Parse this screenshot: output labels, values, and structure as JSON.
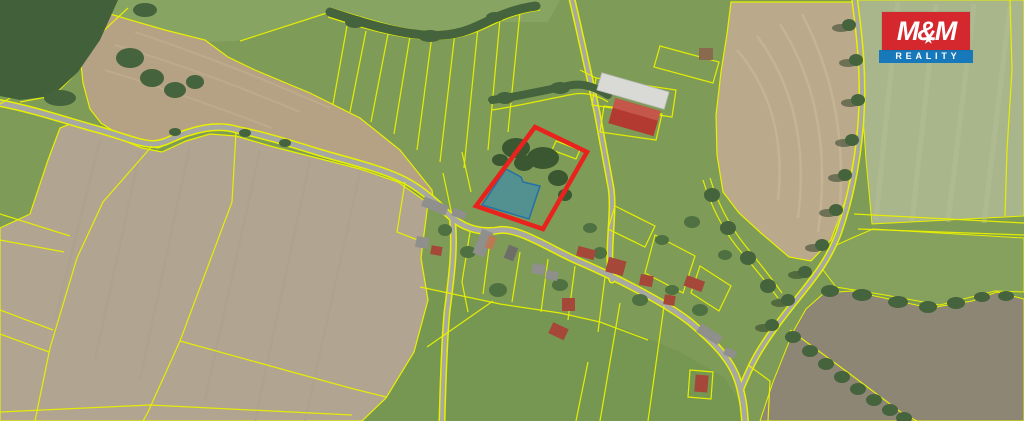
{
  "logo": {
    "brand": "M&M",
    "tagline": "REALITY",
    "star": "★"
  },
  "map": {
    "kind": "aerial-cadastral-map",
    "highlighted_parcel_outline": "#e8231e",
    "selected_area_fill": "#2f86c0",
    "cadastral_line_color": "#e8f000"
  },
  "colors": {
    "c-base": "#7e9b57",
    "c-meadow": "#769751",
    "c-topband": "#8ea968",
    "c-tan1": "#b5a284",
    "c-tan2": "#b1a490",
    "c-tan3": "#bba98b",
    "c-pale": "#a9b58b",
    "c-meadow2": "#85a15d",
    "c-pond": "#8d8674",
    "c-forest": "#42603a",
    "c-tree": "#45633c",
    "c-tree2": "#4f7040",
    "c-parceltree": "#3a5731",
    "c-shadow": "#2e4128",
    "c-road": "#a8a8a2",
    "c-yellow": "#e8f000",
    "c-red": "#e8231e",
    "c-blue": "#2f86c0",
    "c-blue-stroke": "#2470a8",
    "c-roof-red": "#a5483a",
    "c-roof-gray": "#8f8f8b",
    "c-roof-dark": "#6e6e68",
    "c-roof-white": "#d9d9d5",
    "c-roof-orange": "#b97a55",
    "c-roof-brown": "#8a6a4e",
    "c-farm-red": "#b23a30",
    "c-farm-red-lite": "#c4574a",
    "c-st-tan": "#c2b090",
    "c-st-gray": "#a99d8d",
    "c-st-right": "#cabb9d",
    "c-st-pale": "#b6c29a",
    "c-logo-red": "#d4282e",
    "c-logo-blue": "#1779b9"
  }
}
